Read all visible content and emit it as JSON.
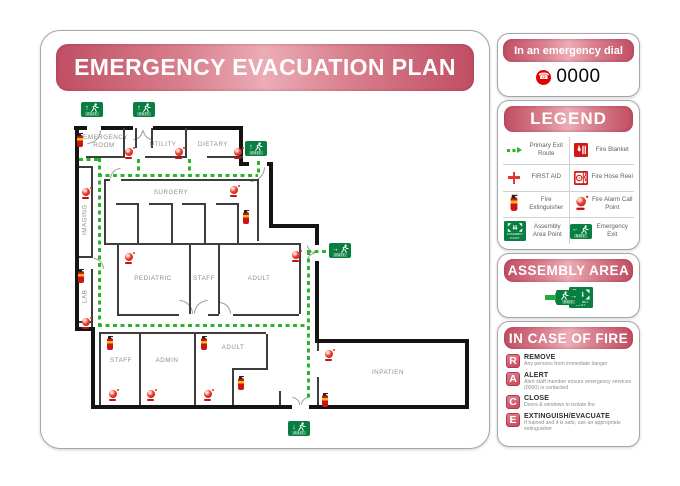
{
  "title": "EMERGENCY EVACUATION PLAN",
  "emergency_dial": {
    "banner": "In an emergency dial",
    "number": "0000"
  },
  "legend": {
    "title": "LEGEND",
    "items": [
      {
        "icon": "primary-exit-route-icon",
        "label": "Primary Exit Route"
      },
      {
        "icon": "fire-blanket-icon",
        "label": "Fire Blanket"
      },
      {
        "icon": "first-aid-icon",
        "label": "FIRST AID"
      },
      {
        "icon": "fire-hose-reel-icon",
        "label": "Fire Hose Reel"
      },
      {
        "icon": "fire-extinguisher-icon",
        "label": "Fire Extinguisher"
      },
      {
        "icon": "fire-alarm-icon",
        "label": "Fire Alarm Call Point"
      },
      {
        "icon": "assembly-area-icon",
        "label": "Assembly Area Point"
      },
      {
        "icon": "emergency-exit-icon",
        "label": "Emergency Exit"
      }
    ]
  },
  "assembly_area": {
    "title": "ASSEMBLY AREA"
  },
  "in_case_of_fire": {
    "title": "IN CASE OF FIRE",
    "steps": [
      {
        "letter": "R",
        "title": "REMOVE",
        "desc": "Any persons from immediate danger"
      },
      {
        "letter": "A",
        "title": "ALERT",
        "desc": "Alert staff member ensure emergency services (0000) is contacted"
      },
      {
        "letter": "C",
        "title": "CLOSE",
        "desc": "Doors & windows to isolate fire"
      },
      {
        "letter": "E",
        "title": "EXTINGUISH/EVACUATE",
        "desc": "If trained and it is safe, use an appropriate extinguisher"
      }
    ]
  },
  "floor_plan": {
    "rooms": [
      "EMERGENCY ROOM",
      "UTILITY",
      "DIETARY",
      "SURGERY",
      "IMAGING",
      "LAB",
      "PEDIATRIC",
      "STAFF",
      "ADULT",
      "STAFF",
      "ADMIN",
      "ADULT",
      "INPATIEN"
    ],
    "exit_label": "EXIT",
    "assembly_point_label": "ASSEMBLY POINT"
  },
  "icons": {
    "arrow_up": "↑",
    "arrow_right": "→",
    "arrow_down": "↓",
    "arrow_left": "←",
    "phone": "☎"
  },
  "colors": {
    "banner_red": "#c5566b",
    "sign_green": "#087f41",
    "route_green": "#29b429",
    "alarm_red": "#d31f2f"
  }
}
